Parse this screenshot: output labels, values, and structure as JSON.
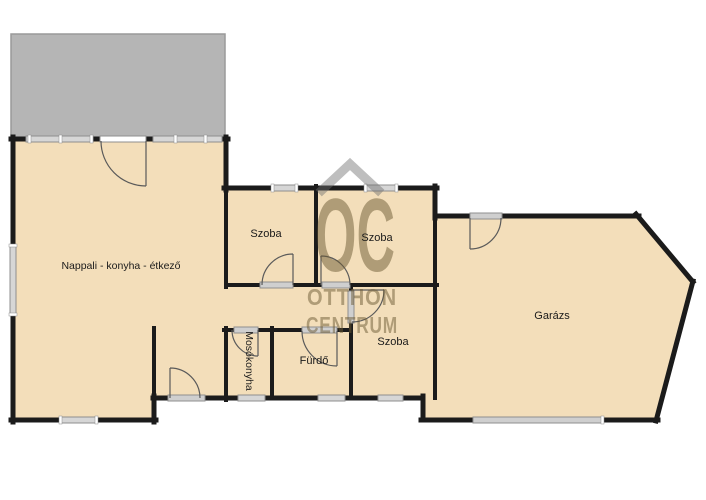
{
  "page": {
    "background": "#ffffff"
  },
  "floorplan": {
    "rooms": {
      "living": {
        "label": "Nappali - konyha - étkező"
      },
      "bedroom1": {
        "label": "Szoba"
      },
      "bedroom2": {
        "label": "Szoba"
      },
      "bedroom3": {
        "label": "Szoba"
      },
      "laundry": {
        "label": "Mosókonyha"
      },
      "bathroom": {
        "label": "Fürdő"
      },
      "garage": {
        "label": "Garázs"
      }
    },
    "colors": {
      "floor": "#f3deba",
      "wall": "#1b1b1b",
      "terrace": "#b5b5b5",
      "terrace_border": "#9a9a9a",
      "window": "#d6d6d6",
      "window_border": "#8f8f8f",
      "door_opening": "#cfcfcf",
      "door_leaf_white": "#ffffff",
      "door_arc": "#5a5a5a",
      "label": "#1a1a1a",
      "watermark_text": "rgba(107,90,51,0.5)",
      "watermark_roof": "rgba(110,110,110,0.45)"
    }
  },
  "watermark": {
    "logo": "OC",
    "line1": "OTTHON",
    "line2": "CENTRUM"
  }
}
